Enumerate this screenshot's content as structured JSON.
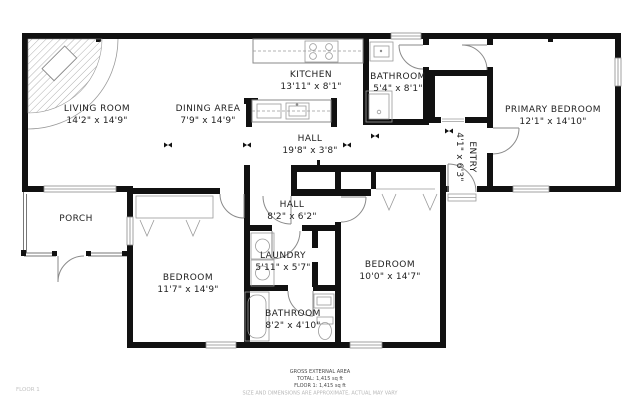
{
  "rooms": {
    "living": {
      "name": "LIVING ROOM",
      "dims": "14'2\" x 14'9\""
    },
    "dining": {
      "name": "DINING AREA",
      "dims": "7'9\" x 14'9\""
    },
    "kitchen": {
      "name": "KITCHEN",
      "dims": "13'11\" x 8'1\""
    },
    "bath_top": {
      "name": "BATHROOM",
      "dims": "5'4\" x 8'1\""
    },
    "hall_main": {
      "name": "HALL",
      "dims": "19'8\" x 3'8\""
    },
    "primary": {
      "name": "PRIMARY BEDROOM",
      "dims": "12'1\" x 14'10\""
    },
    "entry": {
      "name": "ENTRY",
      "dims": "4'1\" x 6'3\""
    },
    "porch": {
      "name": "PORCH"
    },
    "bed_left": {
      "name": "BEDROOM",
      "dims": "11'7\" x 14'9\""
    },
    "hall_small": {
      "name": "HALL",
      "dims": "8'2\" x 6'2\""
    },
    "laundry": {
      "name": "LAUNDRY",
      "dims": "5'11\" x 5'7\""
    },
    "bath_bottom": {
      "name": "BATHROOM",
      "dims": "8'2\" x 4'10\""
    },
    "bed_right": {
      "name": "BEDROOM",
      "dims": "10'0\" x 14'7\""
    }
  },
  "footer": {
    "area_title": "GROSS EXTERNAL AREA",
    "total": "TOTAL: 1,415 sq ft",
    "floor": "FLOOR 1: 1,415 sq ft",
    "disclaimer": "SIZE AND DIMENSIONS ARE APPROXIMATE, ACTUAL MAY VARY"
  },
  "floor_label": "FLOOR 1",
  "colors": {
    "wall": "#111111",
    "text": "#222222",
    "fixture": "#8a8a8a",
    "muted": "#b8b8b8"
  }
}
